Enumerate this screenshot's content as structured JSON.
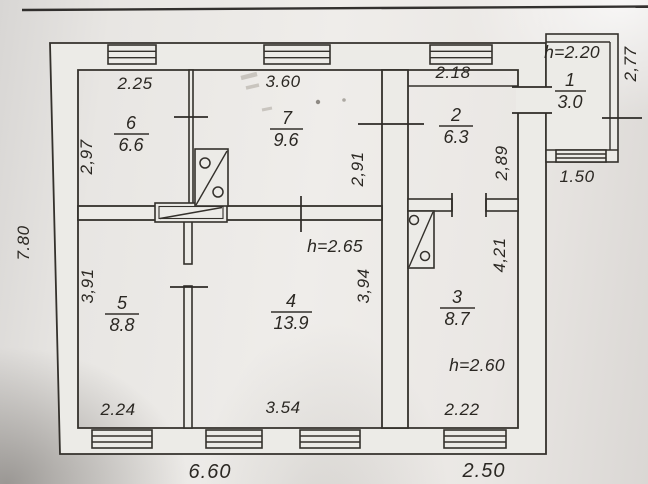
{
  "plan": {
    "rooms": {
      "r1": {
        "number": "1",
        "area": "3.0",
        "height": "h=2.20"
      },
      "r2": {
        "number": "2",
        "area": "6.3"
      },
      "r3": {
        "number": "3",
        "area": "8.7",
        "height": "h=2.60"
      },
      "r4": {
        "number": "4",
        "area": "13.9",
        "height": "h=2.65"
      },
      "r5": {
        "number": "5",
        "area": "8.8"
      },
      "r6": {
        "number": "6",
        "area": "6.6"
      },
      "r7": {
        "number": "7",
        "area": "9.6"
      }
    },
    "dims": {
      "room6_top": "2.25",
      "room7_top": "3.60",
      "room2_top": "2.18",
      "room6_left": "2,97",
      "room7_right": "2,91",
      "room2_right": "2,89",
      "annex_right": "2,77",
      "annex_bottom": "1.50",
      "overall_left": "7.80",
      "room5_left": "3,91",
      "room4_right": "3,94",
      "room3_right": "4,21",
      "room5_bottom": "2.24",
      "room4_bottom": "3.54",
      "room3_bottom": "2.22",
      "total_main_bottom": "6.60",
      "total_right_bottom": "2.50"
    },
    "colors": {
      "ink": "#34312c",
      "paper": "#ecebe7"
    }
  }
}
